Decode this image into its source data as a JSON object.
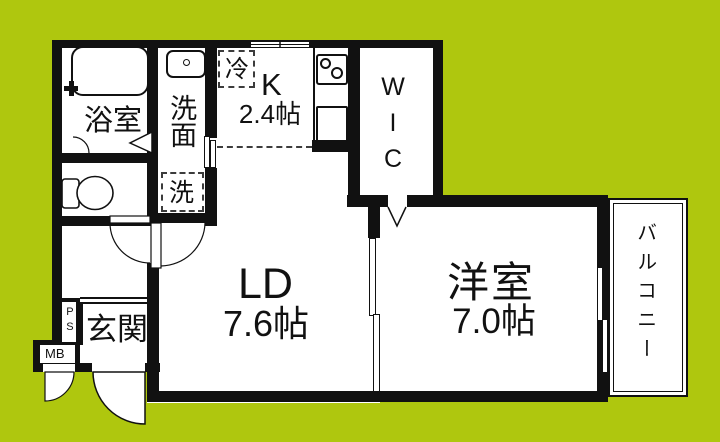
{
  "colors": {
    "background": "#afc70e",
    "wall": "#111111",
    "room_fill": "#ffffff"
  },
  "rooms": {
    "bathroom": {
      "label": "浴室"
    },
    "washroom": {
      "label": "洗面"
    },
    "kitchen": {
      "label": "K",
      "size": "2.4帖"
    },
    "wic": {
      "label": "WIC"
    },
    "living_dining": {
      "label": "LD",
      "size": "7.6帖"
    },
    "western_room": {
      "label": "洋室",
      "size": "7.0帖"
    },
    "entrance": {
      "label": "玄関"
    },
    "balcony": {
      "label": "バルコニー"
    }
  },
  "fixtures": {
    "refrigerator": {
      "label": "冷"
    },
    "washing_machine": {
      "label": "洗"
    },
    "pipe_shaft": {
      "label": "PS"
    },
    "meter_box": {
      "label": "MB"
    }
  }
}
